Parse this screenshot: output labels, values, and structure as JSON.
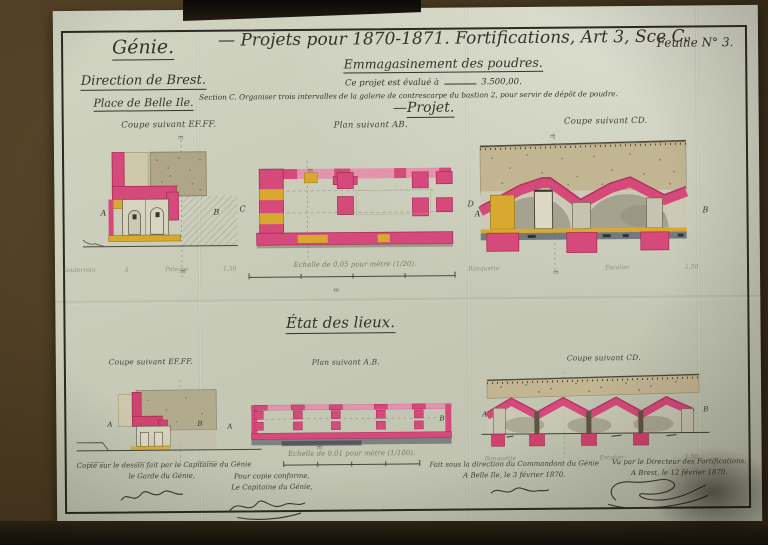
{
  "colors": {
    "paper": "#c8cbb8",
    "ink": "#35322a",
    "masonry_pink": "#d6497b",
    "masonry_pink_light": "#e493ad",
    "wood_yellow": "#d9a92f",
    "earth_tan": "#c2b592",
    "stone_grey": "#a5a290",
    "table_brown": "#4a3a22"
  },
  "letters": {
    "A": "A",
    "B": "B",
    "C": "C",
    "D": "D",
    "E": "E"
  },
  "misc": {
    "dash": "—"
  },
  "header": {
    "org": "Génie.",
    "direction": "Direction de Brest.",
    "place": "Place de Belle Ile.",
    "sheet": "Feuille N° 3.",
    "title": "Projets pour 1870-1871. Fortifications, Art 3, Sce C.",
    "subtitle": "Emmagasinement des poudres.",
    "estimate_label": "Ce projet est évalué à",
    "estimate_amount": "3.500,00.",
    "section_note": "Section C. Organiser trois intervalles de la galerie de contrescarpe du bastion 2, pour servir de dépôt de poudre."
  },
  "projet": {
    "heading": "Projet.",
    "labels": {
      "coupe_ef": "Coupe suivant EF.FF.",
      "plan_ab": "Plan suivant AB.",
      "coupe_cd": "Coupe suivant CD."
    },
    "scale": "Echelle de 0,05 pour mètre (1/20).",
    "annotations_left": [
      "Souterrain",
      "à",
      "Poterne",
      "1,50"
    ],
    "annotations_right": [
      "Banquette",
      "Escalier",
      "1,50"
    ]
  },
  "etat": {
    "heading": "État des lieux.",
    "labels": {
      "coupe_ef": "Coupe suivant EF.FF.",
      "plan_ab": "Plan suivant A.B.",
      "coupe_cd": "Coupe suivant CD."
    },
    "scale": "Echelle de 0,01 pour mètre (1/100).",
    "annotations": [
      "Banquette",
      "Escalier",
      "1,50"
    ]
  },
  "captions": [
    {
      "line1": "Copié sur le dessin fait par le Capitaine du Génie",
      "line2": "le Garde du Génie,"
    },
    {
      "line1": "Pour copie conforme,",
      "line2": "Le Capitaine du Génie,"
    },
    {
      "line1": "Fait sous la direction du Commandant du Génie",
      "line2": "A Belle Ile, le 3 février 1870."
    },
    {
      "line1": "Vu par le Directeur des Fortifications.",
      "line2": "A Brest, le 12 février 1870."
    }
  ]
}
